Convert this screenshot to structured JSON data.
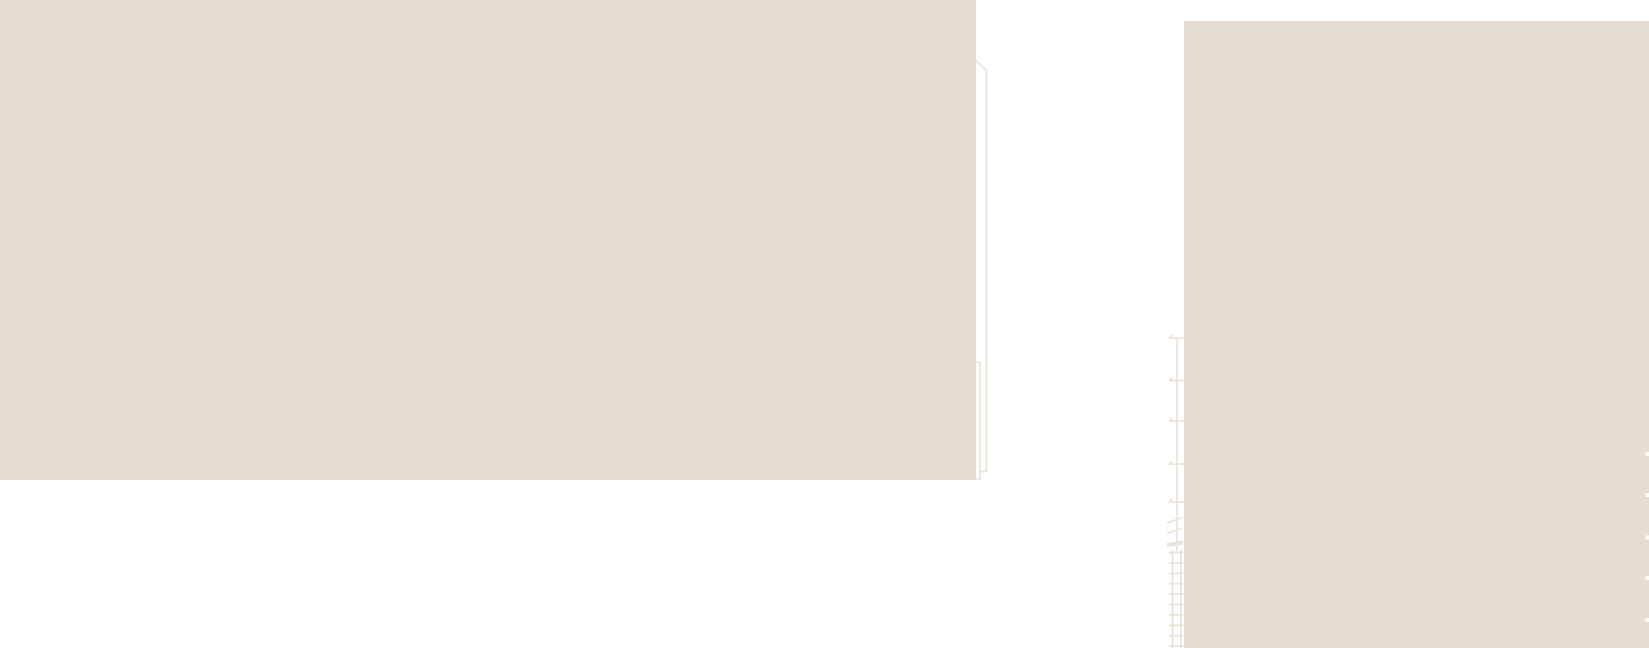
{
  "canvas": {
    "width": 1649,
    "height": 648,
    "background": "#ffffff"
  },
  "colors": {
    "paper": "#e4ddd1",
    "line": "#eae3d8",
    "white_tick": "#ffffff"
  },
  "scene": {
    "blocks": [
      {
        "name": "left-wall-block",
        "x": 0,
        "y": 0,
        "w": 976,
        "h": 480,
        "color": "paper"
      },
      {
        "name": "right-wall-block",
        "x": 1184,
        "y": 21,
        "w": 465,
        "h": 627,
        "color": "paper"
      }
    ],
    "lines": [
      {
        "name": "roof-eave-diagonal",
        "x1": 975.5,
        "y1": 60.5,
        "x2": 986.5,
        "y2": 70.5,
        "w": 1.6
      },
      {
        "name": "outer-edge-line",
        "x1": 986.5,
        "y1": 70,
        "x2": 986.5,
        "y2": 472,
        "w": 1.6
      },
      {
        "name": "downpipe-line",
        "x1": 980,
        "y1": 362,
        "x2": 980,
        "y2": 480,
        "w": 1.6
      },
      {
        "name": "downpipe-top-tick",
        "x1": 975,
        "y1": 362,
        "x2": 980,
        "y2": 362,
        "w": 1.6
      },
      {
        "name": "outer-edge-bottom-connector",
        "x1": 980,
        "y1": 471.5,
        "x2": 987,
        "y2": 471.5,
        "w": 1.6
      },
      {
        "name": "block-foot-tick",
        "x1": 975,
        "y1": 479,
        "x2": 981,
        "y2": 479,
        "w": 1.6
      },
      {
        "name": "mast-line",
        "x1": 1177,
        "y1": 338,
        "x2": 1177,
        "y2": 551,
        "w": 1.6
      },
      {
        "name": "scribble-diagonal-1",
        "x1": 1167,
        "y1": 523,
        "x2": 1182.5,
        "y2": 517.5,
        "w": 1.6
      },
      {
        "name": "scribble-diagonal-2",
        "x1": 1167,
        "y1": 533.5,
        "x2": 1182.5,
        "y2": 528,
        "w": 1.6
      },
      {
        "name": "scribble-bar",
        "x1": 1167,
        "y1": 545,
        "x2": 1183,
        "y2": 542.5,
        "w": 4
      }
    ],
    "tick_rows": [
      {
        "name": "mast-tick",
        "x1": 1169,
        "x2": 1184.5,
        "ys": [
          338,
          380.5,
          421,
          464,
          502
        ],
        "flick_dx": 3,
        "flick_dy": -3,
        "w": 1.6
      }
    ],
    "ladder": {
      "name": "ladder",
      "rail_xs": [
        1172.5,
        1181
      ],
      "rail_y1": 550,
      "rail_y2": 648,
      "rung_x1": 1169,
      "rung_x2": 1183.5,
      "rung_y_start": 552.5,
      "rung_step": 10.4,
      "rung_count": 10,
      "w": 1.8
    },
    "edge_ticks": {
      "name": "facade-course-tick",
      "x": 1645.5,
      "w": 3.5,
      "h": 4,
      "ys": [
        452,
        493,
        535.5,
        576,
        618
      ],
      "color": "white_tick"
    }
  }
}
